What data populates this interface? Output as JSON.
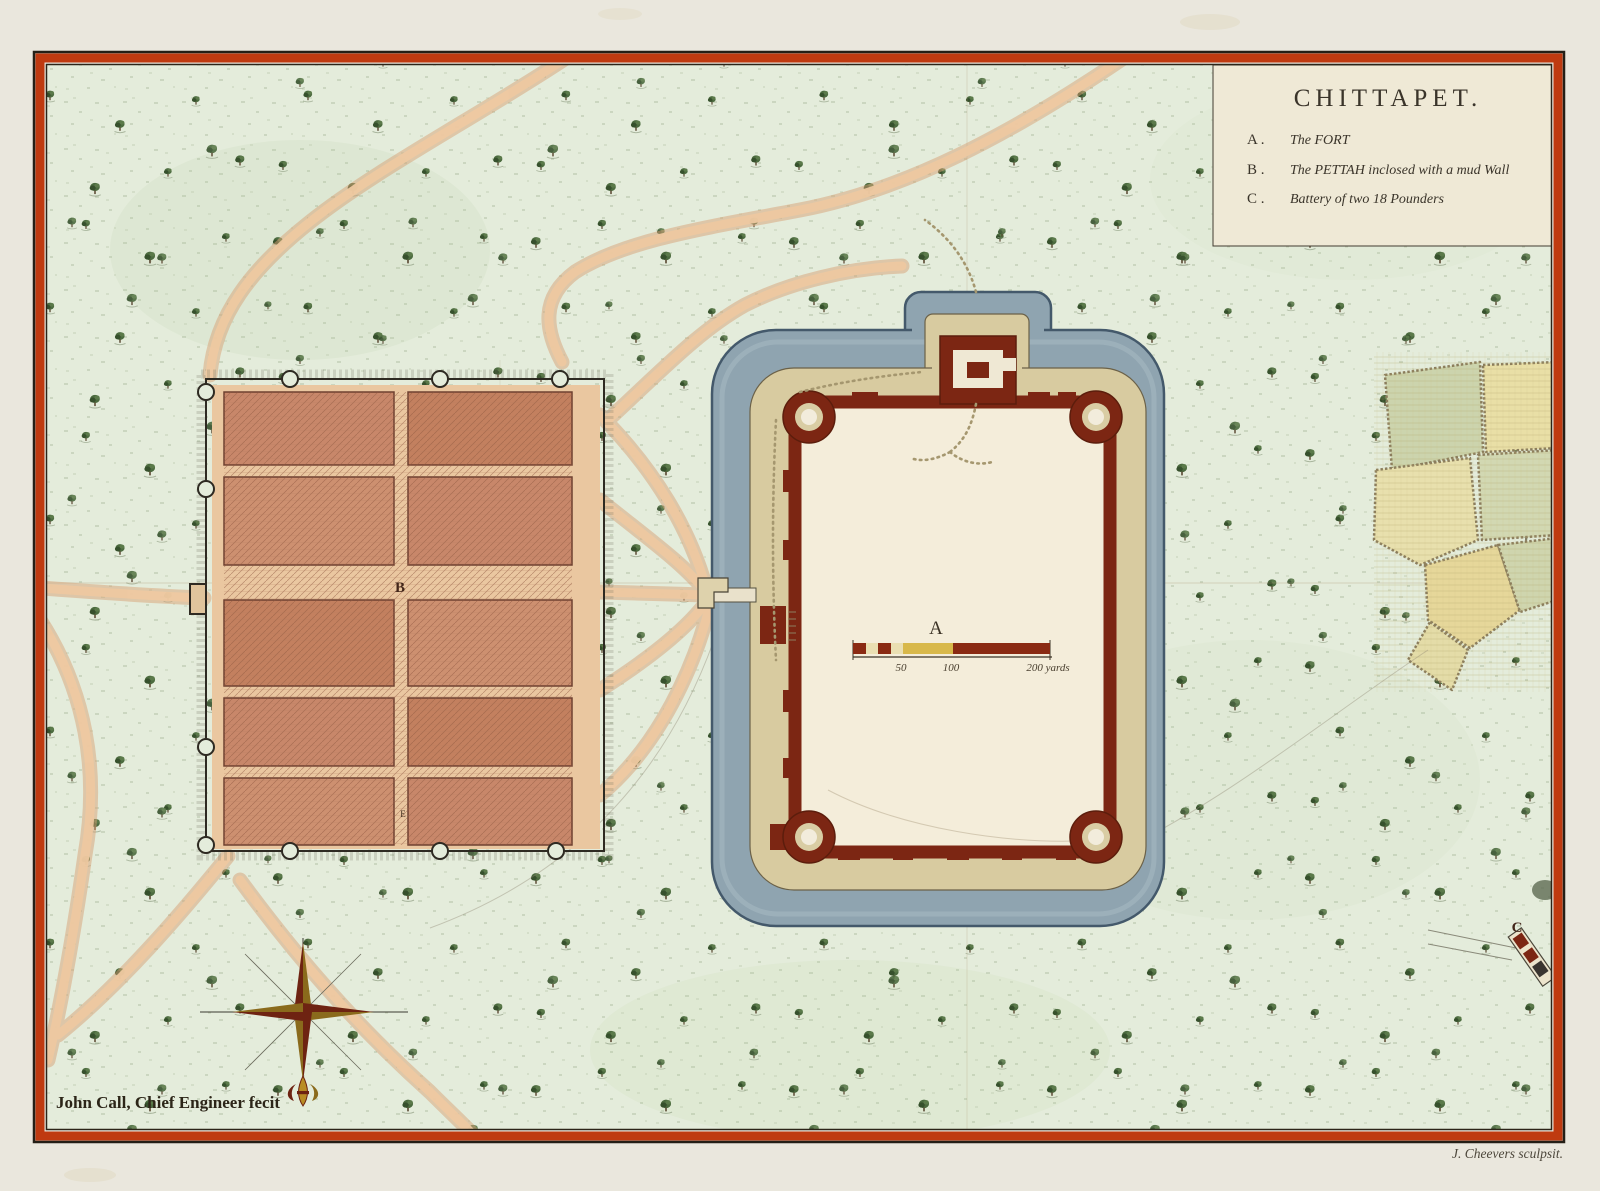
{
  "cartouche": {
    "title": "CHITTAPET.",
    "legend": [
      {
        "key": "A .",
        "text": "The FORT"
      },
      {
        "key": "B .",
        "text": "The PETTAH inclosed with a mud Wall"
      },
      {
        "key": "C .",
        "text": "Battery of two 18 Pounders"
      }
    ]
  },
  "map_labels": {
    "fort": "A",
    "pettah": "B",
    "battery": "C",
    "street_mark": "E"
  },
  "scale_bar": {
    "tick_50": "50",
    "tick_100": "100",
    "end_label": "200 yards"
  },
  "credits": {
    "surveyor": "John Call, Chief Engineer fecit",
    "engraver": "J. Cheevers sculpsit."
  },
  "colors": {
    "border_red": "#bf3a10",
    "ground_green": "#e4ecdb",
    "moat_blue": "#8fa4b0",
    "wall_maroon": "#7c2613",
    "glacis_tan": "#d8cba0",
    "pettah_salmon": "#c8876a",
    "road_tan": "#eec9a1",
    "paper": "#eae7dd"
  }
}
